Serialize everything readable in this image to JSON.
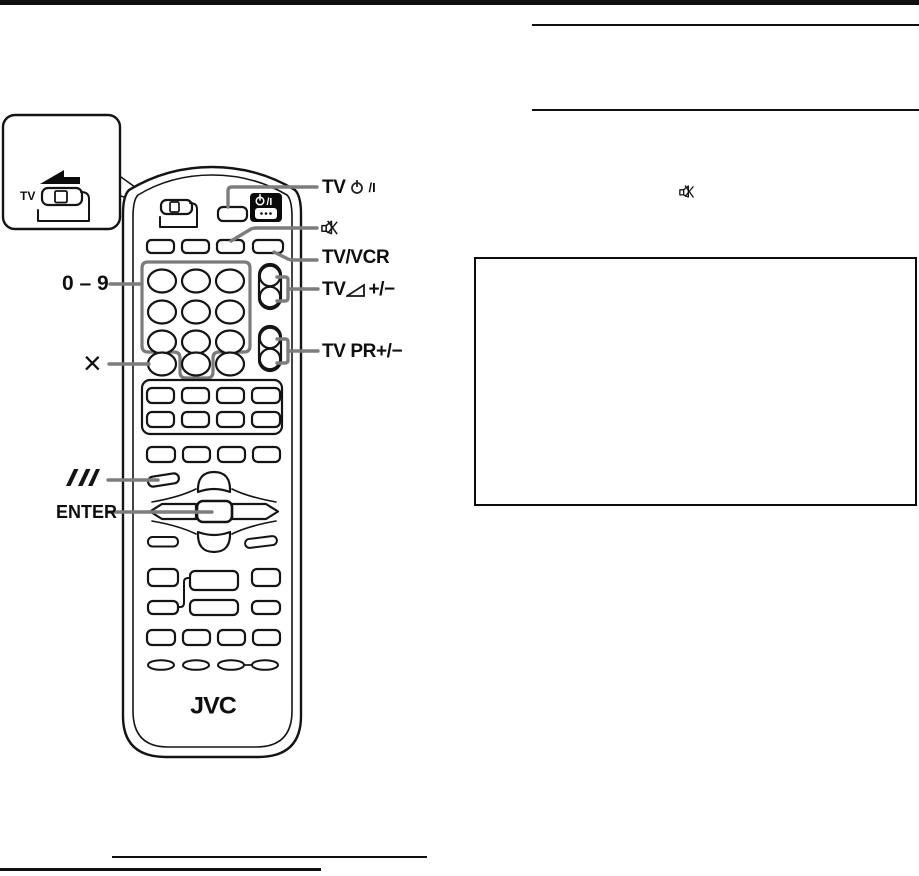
{
  "inset": {
    "tv_label": "TV"
  },
  "labels": {
    "tv_power": {
      "prefix": "TV",
      "suffix": "/I"
    },
    "tv_vcr": "TV/VCR",
    "tv_volume": {
      "prefix": "TV",
      "suffix": "+/−"
    },
    "tv_pr": "TV PR+/−",
    "digits": "0 – 9",
    "cancel": "×",
    "enter": "ENTER"
  },
  "remote": {
    "brand": "JVC",
    "power_button": {
      "suffix": "/I"
    }
  },
  "icons": {
    "power": "power-circle-bar-icon",
    "mute": "mute-speaker-x-icon",
    "volume": "volume-triangle-icon",
    "triple_slash": "triple-slash-icon",
    "slide_arrow": "slide-left-arrow-icon"
  }
}
